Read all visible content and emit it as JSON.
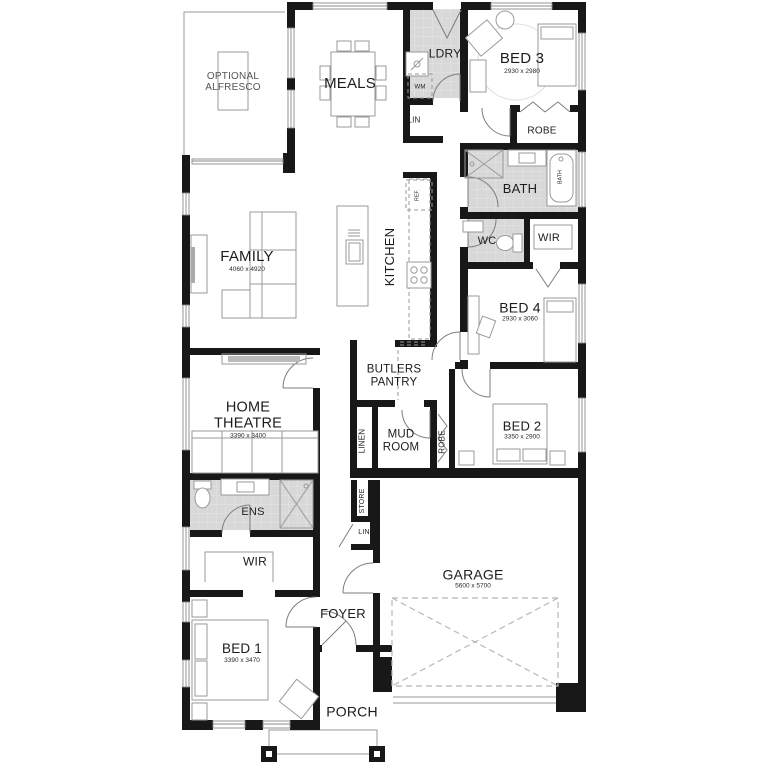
{
  "plan": {
    "labels": {
      "optional_alfresco": {
        "line1": "OPTIONAL",
        "line2": "ALFRESCO"
      },
      "meals": {
        "name": "MEALS"
      },
      "ldry": {
        "name": "LDRY"
      },
      "wm": {
        "name": "WM"
      },
      "lin_upper": {
        "name": "LIN"
      },
      "bed3": {
        "name": "BED 3",
        "dims": "2930 x 2980"
      },
      "robe_bed3": {
        "name": "ROBE"
      },
      "bath": {
        "name": "BATH"
      },
      "bath_tub": {
        "name": "BATH"
      },
      "wc": {
        "name": "WC"
      },
      "wir_upper": {
        "name": "WIR"
      },
      "bed4": {
        "name": "BED 4",
        "dims": "2930 x 3060"
      },
      "family": {
        "name": "FAMILY",
        "dims": "4060 x 4920"
      },
      "kitchen": {
        "name": "KITCHEN"
      },
      "ref": {
        "name": "REF."
      },
      "butlers_pantry": {
        "line1": "BUTLERS",
        "line2": "PANTRY"
      },
      "mud_room": {
        "line1": "MUD",
        "line2": "ROOM"
      },
      "linen": {
        "name": "LINEN"
      },
      "robe_bed2": {
        "name": "ROBE"
      },
      "bed2": {
        "name": "BED 2",
        "dims": "3350 x 2900"
      },
      "home_theatre": {
        "line1": "HOME",
        "line2": "THEATRE",
        "dims": "3390 x 3400"
      },
      "ens": {
        "name": "ENS"
      },
      "store": {
        "name": "STORE"
      },
      "lin_lower": {
        "name": "LIN"
      },
      "wir_master": {
        "name": "WIR"
      },
      "bed1": {
        "name": "BED 1",
        "dims": "3390 x 3470"
      },
      "garage": {
        "name": "GARAGE",
        "dims": "5600 x 5700"
      },
      "foyer": {
        "name": "FOYER"
      },
      "porch": {
        "name": "PORCH"
      }
    },
    "colors": {
      "wall": "#181818",
      "wet_area": "#d8d8d8",
      "window": "#8a8a8a",
      "furniture": "#9a9a9a"
    }
  }
}
